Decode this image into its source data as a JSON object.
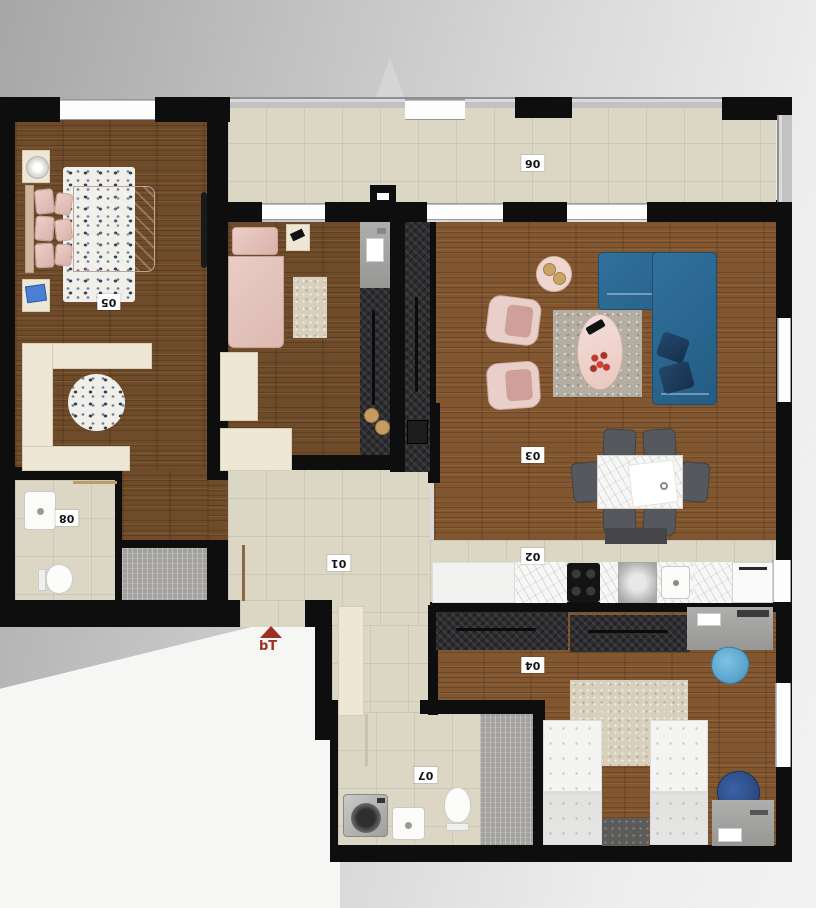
{
  "floorplan": {
    "rooms": {
      "hallway": {
        "number": "01"
      },
      "kitchen": {
        "number": "02"
      },
      "living_room": {
        "number": "03"
      },
      "kids_bedroom": {
        "number": "04"
      },
      "master_bedroom": {
        "number": "05"
      },
      "balcony": {
        "number": "06"
      },
      "bathroom_lower": {
        "number": "07"
      },
      "bathroom_upper": {
        "number": "08"
      }
    },
    "entrance": {
      "label": "bT"
    },
    "colors": {
      "wall": "#0e0e0e",
      "wood_floor": "#6f4b29",
      "tile_floor": "#dcd7c5",
      "sofa_blue": "#2e6b8e",
      "accent_pink": "#e3c4bd",
      "entrance_arrow": "#9e2f23"
    }
  }
}
